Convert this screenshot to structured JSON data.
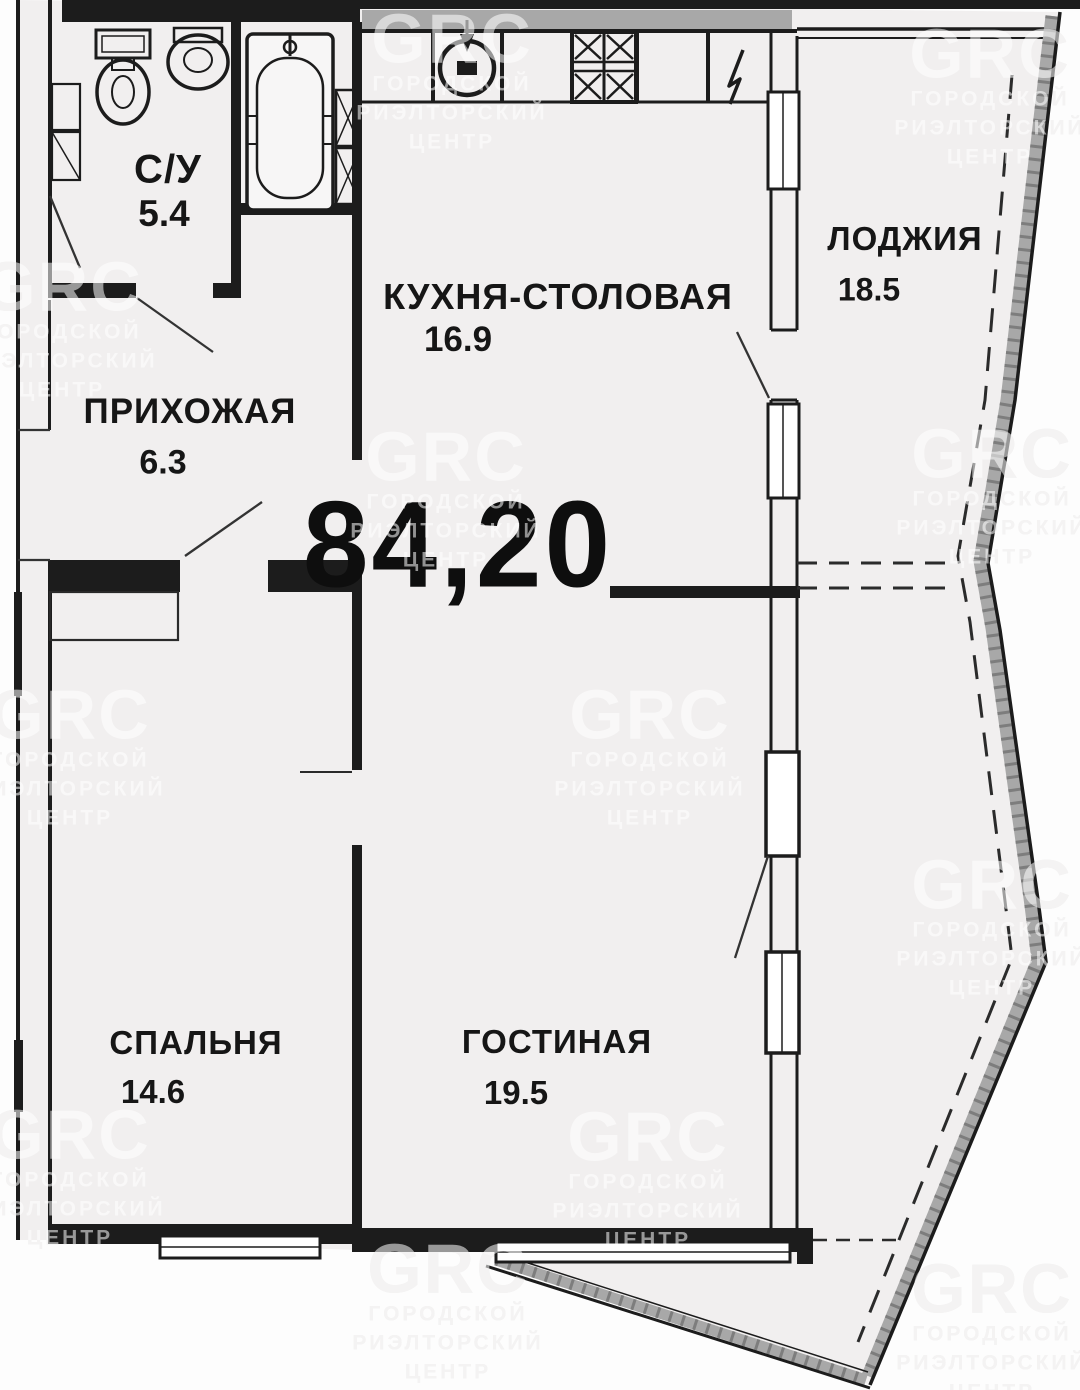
{
  "plan": {
    "total_area": "84,20",
    "units_note": ""
  },
  "rooms": [
    {
      "id": "bathroom",
      "name": "С/У",
      "area": "5.4"
    },
    {
      "id": "hallway",
      "name": "ПРИХОЖАЯ",
      "area": "6.3"
    },
    {
      "id": "kitchen",
      "name": "КУХНЯ-СТОЛОВАЯ",
      "area": "16.9"
    },
    {
      "id": "loggia",
      "name": "ЛОДЖИЯ",
      "area": "18.5"
    },
    {
      "id": "bedroom",
      "name": "СПАЛЬНЯ",
      "area": "14.6"
    },
    {
      "id": "living-room",
      "name": "ГОСТИНАЯ",
      "area": "19.5"
    }
  ],
  "watermark": {
    "logo": "GRC",
    "line1": "ГОРОДСКОЙ",
    "line2": "РИЭЛТОРСКИЙ",
    "line3": "ЦЕНТР"
  },
  "colors": {
    "wall": "#1c1c1c",
    "floor": "#f1efef",
    "band_gray": "#a8a8a8",
    "watermark_gray": "#e7e5e4"
  }
}
